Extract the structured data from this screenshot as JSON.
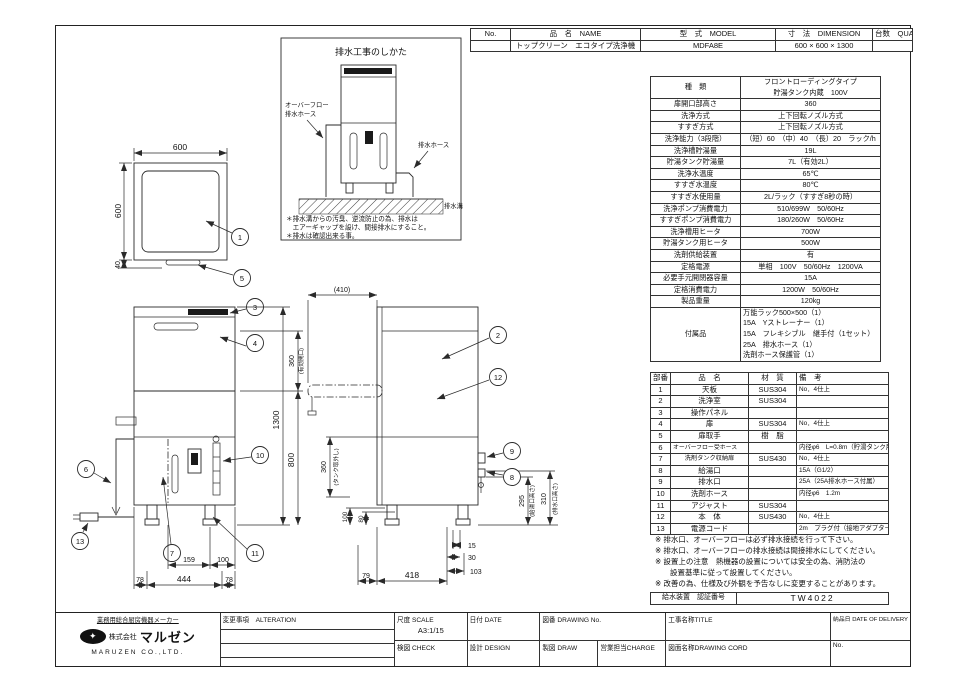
{
  "sheet": {
    "header_table": {
      "col_no": "No.",
      "col_name": "品　名　NAME",
      "col_model": "型　式　MODEL",
      "col_dim": "寸　法　DIMENSION",
      "col_qty": "台数　QUANTITY",
      "row_no": "",
      "row_name": "トップクリーン　エコタイプ洗浄機",
      "row_model": "MDFA8E",
      "row_dim": "600 × 600 × 1300",
      "row_qty": ""
    },
    "spec_table": {
      "rows": [
        {
          "label": "種　類",
          "value": "フロントローディングタイプ\n貯湯タンク内蔵　100V"
        },
        {
          "label": "扉開口部高さ",
          "value": "360"
        },
        {
          "label": "洗浄方式",
          "value": "上下回転ノズル方式"
        },
        {
          "label": "すすぎ方式",
          "value": "上下回転ノズル方式"
        },
        {
          "label": "洗浄能力（3段階）",
          "value": "（短）60　（中）40　（長）20　ラック/h"
        },
        {
          "label": "洗浄槽貯湯量",
          "value": "19L"
        },
        {
          "label": "貯湯タンク貯湯量",
          "value": "7L（有効2L）"
        },
        {
          "label": "洗浄水温度",
          "value": "65℃"
        },
        {
          "label": "すすぎ水温度",
          "value": "80℃"
        },
        {
          "label": "すすぎ水使用量",
          "value": "2L/ラック（すすぎ8秒の時）"
        },
        {
          "label": "洗浄ポンプ消費電力",
          "value": "510/699W　50/60Hz"
        },
        {
          "label": "すすぎポンプ消費電力",
          "value": "180/260W　50/60Hz"
        },
        {
          "label": "洗浄槽用ヒータ",
          "value": "700W"
        },
        {
          "label": "貯湯タンク用ヒータ",
          "value": "500W"
        },
        {
          "label": "洗剤供給装置",
          "value": "有"
        },
        {
          "label": "定格電源",
          "value": "単相　100V　50/60Hz　1200VA"
        },
        {
          "label": "必要手元開閉器容量",
          "value": "15A"
        },
        {
          "label": "定格消費電力",
          "value": "1200W　50/60Hz"
        },
        {
          "label": "製品重量",
          "value": "120kg"
        },
        {
          "label": "付属品",
          "value": "万能ラック500×500（1）\n15A　Yストレーナー（1）\n15A　フレキシブル　継手付（1セット）\n25A　排水ホース（1）\n洗剤ホース保護管（1）"
        }
      ]
    },
    "parts_table": {
      "headers": {
        "no": "部番",
        "name": "品　名",
        "material": "材　質",
        "remarks": "備　考"
      },
      "rows": [
        {
          "no": "1",
          "name": "天板",
          "material": "SUS304",
          "remarks": "No．4仕上"
        },
        {
          "no": "2",
          "name": "洗浄室",
          "material": "SUS304",
          "remarks": ""
        },
        {
          "no": "3",
          "name": "操作パネル",
          "material": "",
          "remarks": ""
        },
        {
          "no": "4",
          "name": "扉",
          "material": "SUS304",
          "remarks": "No．4仕上"
        },
        {
          "no": "5",
          "name": "扉取手",
          "material": "樹　脂",
          "remarks": ""
        },
        {
          "no": "6",
          "name": "オーバーフロー受ホース",
          "material": "",
          "remarks": "内径φ6　L=0.8m（貯湯タンク用）"
        },
        {
          "no": "7",
          "name": "洗剤タンク収納扉",
          "material": "SUS430",
          "remarks": "No．4仕上"
        },
        {
          "no": "8",
          "name": "給湯口",
          "material": "",
          "remarks": "15A（G1/2）"
        },
        {
          "no": "9",
          "name": "排水口",
          "material": "",
          "remarks": "25A（25A排水ホース付属）"
        },
        {
          "no": "10",
          "name": "洗剤ホース",
          "material": "",
          "remarks": "内径φ6　1.2m"
        },
        {
          "no": "11",
          "name": "アジャスト",
          "material": "SUS304",
          "remarks": ""
        },
        {
          "no": "12",
          "name": "本　体",
          "material": "SUS430",
          "remarks": "No．4仕上"
        },
        {
          "no": "13",
          "name": "電源コード",
          "material": "",
          "remarks": "2m　プラグ付（接地アダプター付）"
        }
      ]
    },
    "notes": [
      "※ 排水口、オーバーフローは必ず排水接続を行って下さい。",
      "※ 排水口、オーバーフローの排水接続は間接排水にしてください。",
      "※ 設置上の注意　熱機器の設置については安全の為、消防法の",
      "　　設置基準に従って設置してください。",
      "※ 改善の為、仕様及び外観を予告なしに変更することがあります。"
    ],
    "certification": {
      "label": "給水装置　認証番号",
      "value": "TW4022"
    },
    "title_block": {
      "tagline": "業務用総合厨房機器メーカー",
      "company_prefix": "株式会社",
      "company_name": "マルゼン",
      "company_en": "MARUZEN CO.,LTD.",
      "logo_glyph": "✦",
      "alteration": "変更事項　ALTERATION",
      "scale_label": "尺度 SCALE",
      "scale_value": "A3:1/15",
      "date_label": "日付 DATE",
      "check_label": "検図 CHECK",
      "design_label": "設計 DESIGN",
      "draw_label": "製図 DRAW",
      "charge_label": "営業担当CHARGE",
      "drawing_no_label": "図番 DRAWING No.",
      "title_label": "工事名称TITLE",
      "cord_label": "図面名称DRAWING CORD",
      "delivery_label": "納品日  DATE OF DELIVERY",
      "no_label": "No."
    }
  },
  "drawing": {
    "inset": {
      "title": "排水工事のしかた",
      "label_overflow_1": "オーバーフロー",
      "label_overflow_2": "排水ホース",
      "label_drain_hose": "排水ホース",
      "label_drain_trench": "排水溝",
      "note1": "＊排水溝からの汚臭、逆流防止の為、排水は",
      "note2": "　エアーギャップを設け、間接排水にすること。",
      "note3": "＊排水は確認出来る事。"
    },
    "top_view": {
      "dim_width": "600",
      "dim_depth": "600",
      "dim_40": "40"
    },
    "front_view": {
      "dim_height": "1300",
      "dim_opening": "360",
      "dim_opening_note": "(有効開口)",
      "dim_800": "800",
      "dim_78L": "78",
      "dim_444": "444",
      "dim_78R": "78",
      "dim_159": "159",
      "dim_100": "100"
    },
    "side_view": {
      "dim_410": "(410)",
      "dim_360": "360",
      "dim_360_note": "(タンク取外し)",
      "dim_100": "100",
      "dim_80": "80",
      "dim_79": "79",
      "dim_418": "418",
      "dim_103": "103",
      "dim_15": "15",
      "dim_30": "30",
      "dim_295": "295",
      "dim_295_note": "(給湯口高さ)",
      "dim_310": "310",
      "dim_310_note": "(排水口高さ)"
    },
    "balloons": [
      "1",
      "2",
      "3",
      "4",
      "5",
      "6",
      "7",
      "8",
      "9",
      "10",
      "11",
      "12",
      "13"
    ]
  }
}
